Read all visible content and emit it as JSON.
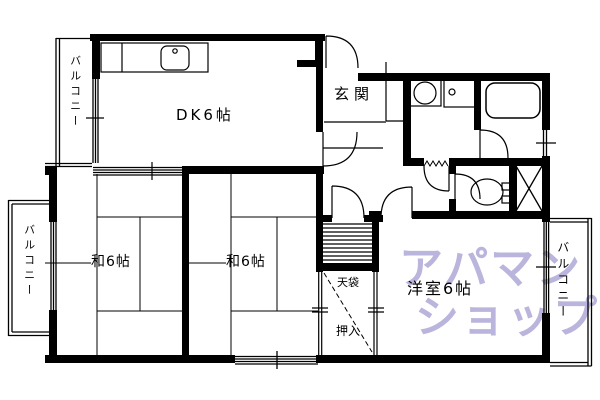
{
  "colors": {
    "line": "#000000",
    "background": "#ffffff",
    "watermark_purple": "#8178C0"
  },
  "labels": {
    "balcony_top_left": "バルコニー",
    "balcony_middle_left": "バルコニー",
    "balcony_right": "バルコニー",
    "dining_kitchen": "DK6帖",
    "entrance": "玄関",
    "japanese_room_left": "和6帖",
    "japanese_room_center": "和6帖",
    "western_room": "洋室6帖",
    "upper_closet": "天袋",
    "closet": "押入"
  },
  "watermark": {
    "line1": "アパマン",
    "line2": "ショップ"
  },
  "fixtures": {
    "kitchen_counter": "kitchen-counter-icon",
    "kitchen_sink": "kitchen-sink-icon",
    "washing_machine": "washing-machine-icon",
    "wash_basin": "wash-basin-icon",
    "bathtub": "bathtub-icon",
    "toilet": "toilet-icon",
    "pipe_space": "pipe-space-x-icon",
    "storage_shelves": "storage-shelves-icon"
  }
}
